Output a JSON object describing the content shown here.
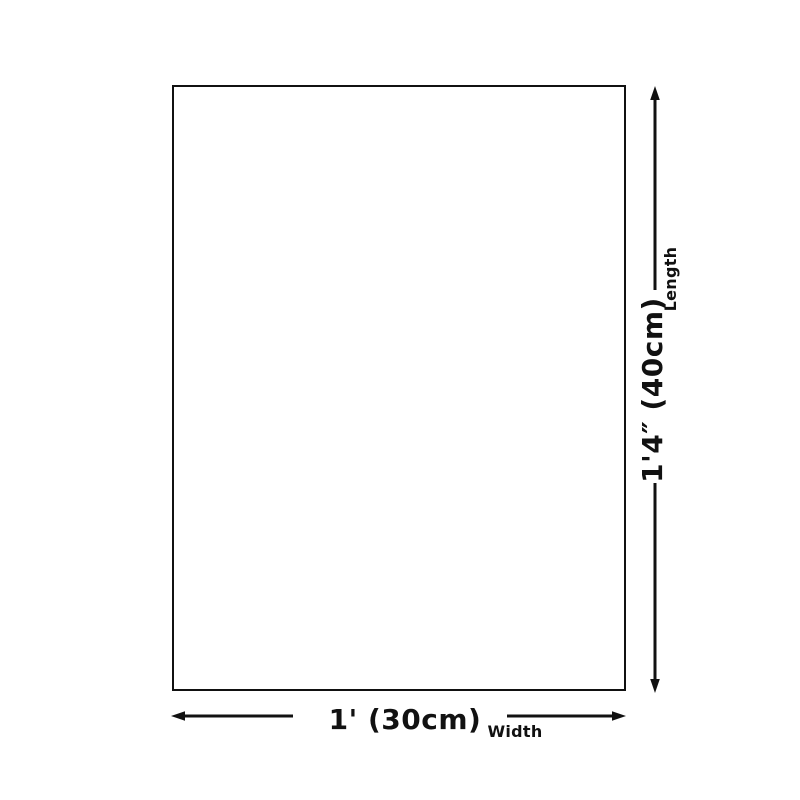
{
  "colors": {
    "line": "#111111",
    "background": "#ffffff",
    "rect_fill": "#ffffff"
  },
  "diagram": {
    "length": {
      "value": "1'4″ (40cm)",
      "label": "Length"
    },
    "width": {
      "value": "1' (30cm)",
      "label": "Width"
    }
  }
}
